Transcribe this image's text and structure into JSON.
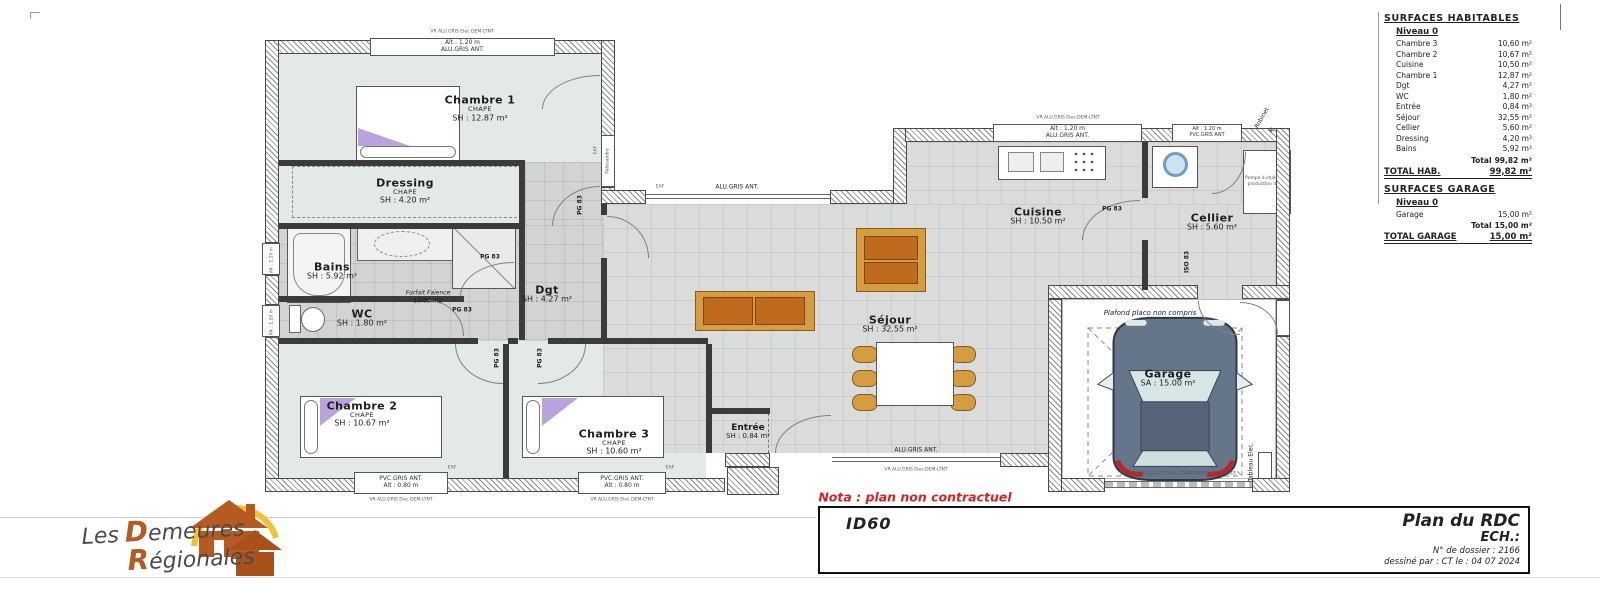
{
  "surfaces": {
    "title": "SURFACES HABITABLES",
    "niveau": "Niveau 0",
    "rows": [
      {
        "label": "Chambre 3",
        "value": "10,60 m²"
      },
      {
        "label": "Chambre 2",
        "value": "10,67 m²"
      },
      {
        "label": "Cuisine",
        "value": "10,50 m²"
      },
      {
        "label": "Chambre 1",
        "value": "12,87 m²"
      },
      {
        "label": "Dgt",
        "value": "4,27 m²"
      },
      {
        "label": "WC",
        "value": "1,80 m²"
      },
      {
        "label": "Entrée",
        "value": "0,84 m²"
      },
      {
        "label": "Séjour",
        "value": "32,55 m²"
      },
      {
        "label": "Cellier",
        "value": "5,60 m²"
      },
      {
        "label": "Dressing",
        "value": "4,20 m²"
      },
      {
        "label": "Bains",
        "value": "5,92 m²"
      }
    ],
    "total_label": "Total",
    "total_value": "99,82 m²",
    "total_hab_label": "TOTAL HAB.",
    "total_hab_value": "99,82 m²",
    "garage_title": "SURFACES GARAGE",
    "garage_niveau": "Niveau 0",
    "garage_row": {
      "label": "Garage",
      "value": "15,00 m²"
    },
    "garage_total_label": "Total",
    "garage_total_value": "15,00 m²",
    "total_garage_label": "TOTAL GARAGE",
    "total_garage_value": "15,00 m²"
  },
  "rooms": {
    "chambre1": {
      "name": "Chambre 1",
      "sub": "CHAPE",
      "area": "SH : 12.87 m²"
    },
    "dressing": {
      "name": "Dressing",
      "sub": "CHAPE",
      "area": "SH : 4.20 m²"
    },
    "bains": {
      "name": "Bains",
      "area": "SH : 5.92 m²"
    },
    "wc": {
      "name": "WC",
      "area": "SH : 1.80 m²"
    },
    "dgt": {
      "name": "Dgt",
      "area": "SH : 4.27 m²"
    },
    "chambre2": {
      "name": "Chambre 2",
      "sub": "CHAPE",
      "area": "SH : 10.67 m²"
    },
    "chambre3": {
      "name": "Chambre 3",
      "sub": "CHAPE",
      "area": "SH : 10.60 m²"
    },
    "entree": {
      "name": "Entrée",
      "area": "SH : 0.84 m²"
    },
    "sejour": {
      "name": "Séjour",
      "area": "SH : 32.55 m²"
    },
    "cuisine": {
      "name": "Cuisine",
      "area": "SH : 10.50 m²"
    },
    "cellier": {
      "name": "Cellier",
      "area": "SH : 5.60 m²"
    },
    "garage": {
      "name": "Garage",
      "area": "SA : 15.00 m²"
    }
  },
  "doors": {
    "pg83": "PG 83",
    "iso83": "ISO 83",
    "palissandre": "Palissandre"
  },
  "windows": {
    "top_alt": "Alt : 1.20 m",
    "top_type": "ALU.GRIS ANT.",
    "cellier_alt": "Alt : 1.20 m",
    "cellier_type": "PVC.GRIS ANT",
    "bottom_type": "PVC.GRIS ANT.",
    "bottom_alt": "Alt : 0.80 m",
    "sejour_type": "ALU.GRIS ANT.",
    "side_alt": "Alt : 1.20 m",
    "vr": "VR ALU.GRIS Elec DEM-LTNT",
    "eaf": "EAF"
  },
  "annotations": {
    "forfait1": "Forfait Faïence",
    "forfait2": "10.00 m2",
    "plafond": "Plafond placo non compris",
    "robinet": "Robinet",
    "tableau": "Tableau Elec.",
    "pompe": "Pompe à chaleur et production d'ECS",
    "garage_door": "SECTIONNELLE AVEC PRE-EQUIPEMENT MOTORISEE"
  },
  "title_block": {
    "nota": "Nota : plan non contractuel",
    "model": "ID60",
    "title": "Plan du RDC",
    "scale": "ECH.:",
    "dossier": "N° de dossier : 2166",
    "author": "dessiné par : CT   le : 04 07 2024"
  },
  "logo": {
    "word1": "Les",
    "cap1": "D",
    "rest1": "emeures",
    "cap2": "R",
    "rest2": "égionales"
  },
  "colors": {
    "nota_red": "#d92121",
    "sofa_orange": "#bf6a1c",
    "chair_tan": "#d49d3f",
    "pillow_purple": "#b9a2de",
    "logo_orange": "#b65a1f",
    "logo_yellow": "#f2c230",
    "wall_dark": "#3b3b3b"
  }
}
